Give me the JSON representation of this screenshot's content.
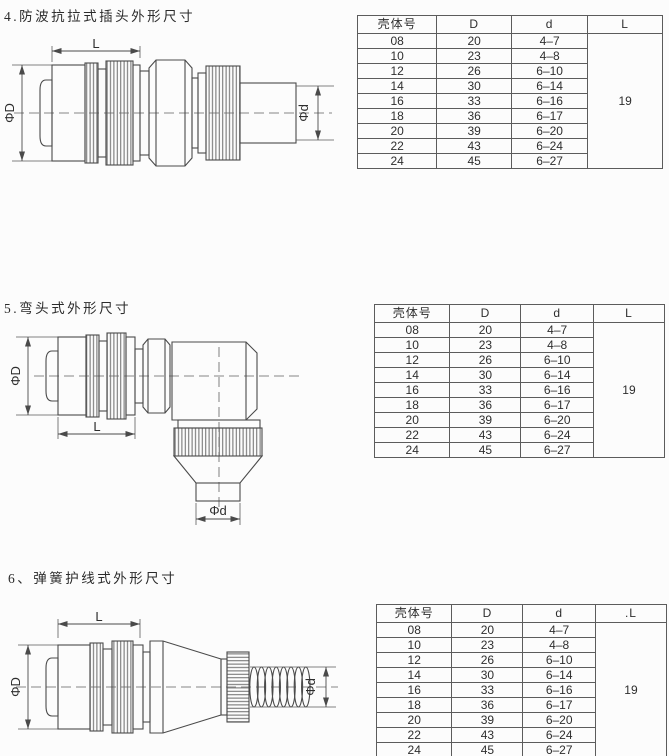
{
  "document": {
    "background": "#fcfcfc",
    "line_color": "#4a4a4a",
    "text_color": "#2e2e2e",
    "border_color": "#5c5c5c"
  },
  "sections": [
    {
      "title": "4.防波抗拉式插头外形尺寸",
      "drawing": {
        "name": "straight-plug",
        "labels": {
          "length": "L",
          "outer_diameter": "ΦD",
          "inner_diameter": "Φd"
        }
      },
      "table": {
        "headers": [
          "壳体号",
          "D",
          "d",
          "L"
        ],
        "rows": [
          [
            "08",
            "20",
            "4–7"
          ],
          [
            "10",
            "23",
            "4–8"
          ],
          [
            "12",
            "26",
            "6–10"
          ],
          [
            "14",
            "30",
            "6–14"
          ],
          [
            "16",
            "33",
            "6–16"
          ],
          [
            "18",
            "36",
            "6–17"
          ],
          [
            "20",
            "39",
            "6–20"
          ],
          [
            "22",
            "43",
            "6–24"
          ],
          [
            "24",
            "45",
            "6–27"
          ]
        ],
        "merged_L": "19"
      }
    },
    {
      "title": "5.弯头式外形尺寸",
      "drawing": {
        "name": "elbow-plug",
        "labels": {
          "length": "L",
          "outer_diameter": "ΦD",
          "inner_diameter": "Φd"
        }
      },
      "table": {
        "headers": [
          "壳体号",
          "D",
          "d",
          "L"
        ],
        "rows": [
          [
            "08",
            "20",
            "4–7"
          ],
          [
            "10",
            "23",
            "4–8"
          ],
          [
            "12",
            "26",
            "6–10"
          ],
          [
            "14",
            "30",
            "6–14"
          ],
          [
            "16",
            "33",
            "6–16"
          ],
          [
            "18",
            "36",
            "6–17"
          ],
          [
            "20",
            "39",
            "6–20"
          ],
          [
            "22",
            "43",
            "6–24"
          ],
          [
            "24",
            "45",
            "6–27"
          ]
        ],
        "merged_L": "19"
      }
    },
    {
      "title": "6、弹簧护线式外形尺寸",
      "drawing": {
        "name": "spring-guard-plug",
        "labels": {
          "length": "L",
          "outer_diameter": "ΦD",
          "inner_diameter": "Φd"
        }
      },
      "table": {
        "headers": [
          "壳体号",
          "D",
          "d",
          ".L"
        ],
        "rows": [
          [
            "08",
            "20",
            "4–7"
          ],
          [
            "10",
            "23",
            "4–8"
          ],
          [
            "12",
            "26",
            "6–10"
          ],
          [
            "14",
            "30",
            "6–14"
          ],
          [
            "16",
            "33",
            "6–16"
          ],
          [
            "18",
            "36",
            "6–17"
          ],
          [
            "20",
            "39",
            "6–20"
          ],
          [
            "22",
            "43",
            "6–24"
          ],
          [
            "24",
            "45",
            "6–27"
          ]
        ],
        "merged_L": "19"
      }
    }
  ]
}
